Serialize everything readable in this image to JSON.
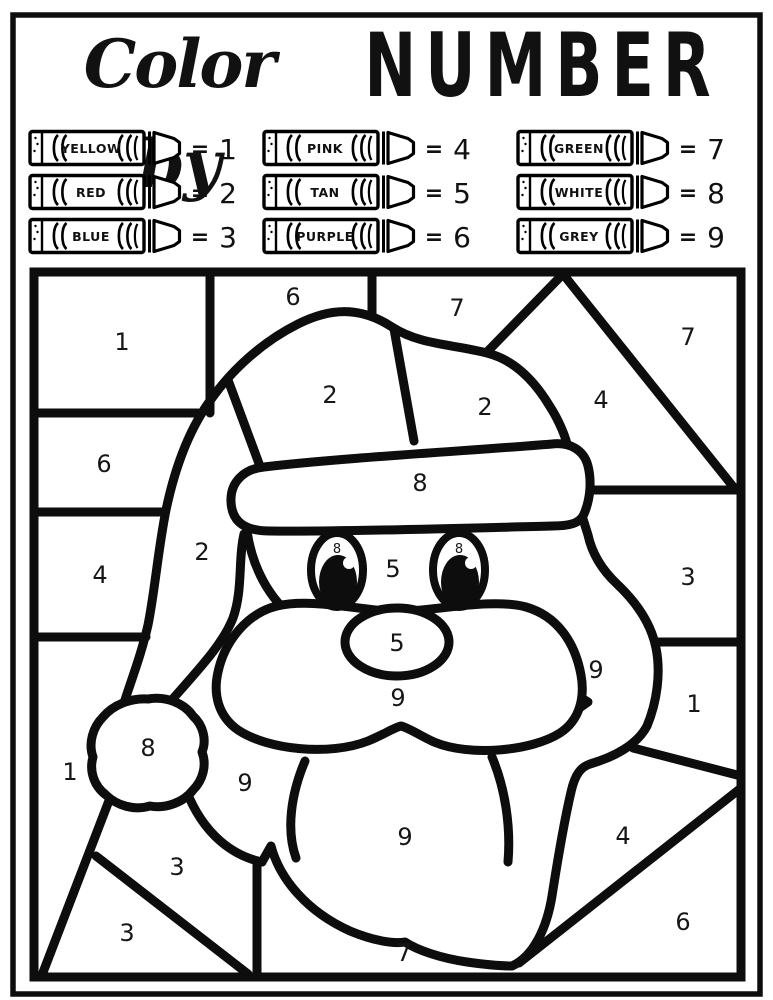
{
  "title": {
    "script": "Color by",
    "block": "NUMBER"
  },
  "legend_equals": "=",
  "legend": [
    {
      "color": "YELLOW",
      "number": "1"
    },
    {
      "color": "RED",
      "number": "2"
    },
    {
      "color": "BLUE",
      "number": "3"
    },
    {
      "color": "PINK",
      "number": "4"
    },
    {
      "color": "TAN",
      "number": "5"
    },
    {
      "color": "PURPLE",
      "number": "6"
    },
    {
      "color": "GREEN",
      "number": "7"
    },
    {
      "color": "WHITE",
      "number": "8"
    },
    {
      "color": "GREY",
      "number": "9"
    }
  ],
  "colors": {
    "ink": "#0d0d0d",
    "paper": "#ffffff"
  },
  "puzzle": {
    "subject": "santa-claus-face",
    "region_labels": [
      {
        "name": "top-left",
        "number": "1",
        "x": 122,
        "y": 350
      },
      {
        "name": "left-upper",
        "number": "6",
        "x": 104,
        "y": 472
      },
      {
        "name": "left-mid",
        "number": "4",
        "x": 100,
        "y": 583
      },
      {
        "name": "top-middle",
        "number": "6",
        "x": 293,
        "y": 305
      },
      {
        "name": "top-center",
        "number": "7",
        "x": 457,
        "y": 316
      },
      {
        "name": "top-right",
        "number": "7",
        "x": 688,
        "y": 345
      },
      {
        "name": "hat-right-triangle",
        "number": "4",
        "x": 601,
        "y": 408
      },
      {
        "name": "hat-dome-left",
        "number": "2",
        "x": 330,
        "y": 403
      },
      {
        "name": "hat-dome-right",
        "number": "2",
        "x": 485,
        "y": 415
      },
      {
        "name": "hat-tail",
        "number": "2",
        "x": 202,
        "y": 560
      },
      {
        "name": "hat-band",
        "number": "8",
        "x": 420,
        "y": 491
      },
      {
        "name": "right-upper",
        "number": "3",
        "x": 688,
        "y": 585
      },
      {
        "name": "right-mid",
        "number": "1",
        "x": 694,
        "y": 712
      },
      {
        "name": "right-diag-band",
        "number": "4",
        "x": 623,
        "y": 844
      },
      {
        "name": "bottom-right",
        "number": "6",
        "x": 683,
        "y": 930
      },
      {
        "name": "beard-curl",
        "number": "9",
        "x": 596,
        "y": 678
      },
      {
        "name": "left-lower",
        "number": "1",
        "x": 70,
        "y": 780
      },
      {
        "name": "pom-pom",
        "number": "8",
        "x": 148,
        "y": 756
      },
      {
        "name": "beard-left",
        "number": "9",
        "x": 245,
        "y": 791
      },
      {
        "name": "bottom-left-upper",
        "number": "3",
        "x": 177,
        "y": 875
      },
      {
        "name": "bottom-left-lower",
        "number": "3",
        "x": 127,
        "y": 941
      },
      {
        "name": "face",
        "number": "5",
        "x": 393,
        "y": 577
      },
      {
        "name": "nose",
        "number": "5",
        "x": 397,
        "y": 651
      },
      {
        "name": "mustache",
        "number": "9",
        "x": 398,
        "y": 706
      },
      {
        "name": "beard-chin",
        "number": "9",
        "x": 405,
        "y": 845
      },
      {
        "name": "bottom-center",
        "number": "7",
        "x": 404,
        "y": 961
      },
      {
        "name": "left-eye",
        "number": "8",
        "x": 337,
        "y": 553,
        "small": true
      },
      {
        "name": "right-eye",
        "number": "8",
        "x": 459,
        "y": 553,
        "small": true
      }
    ]
  }
}
